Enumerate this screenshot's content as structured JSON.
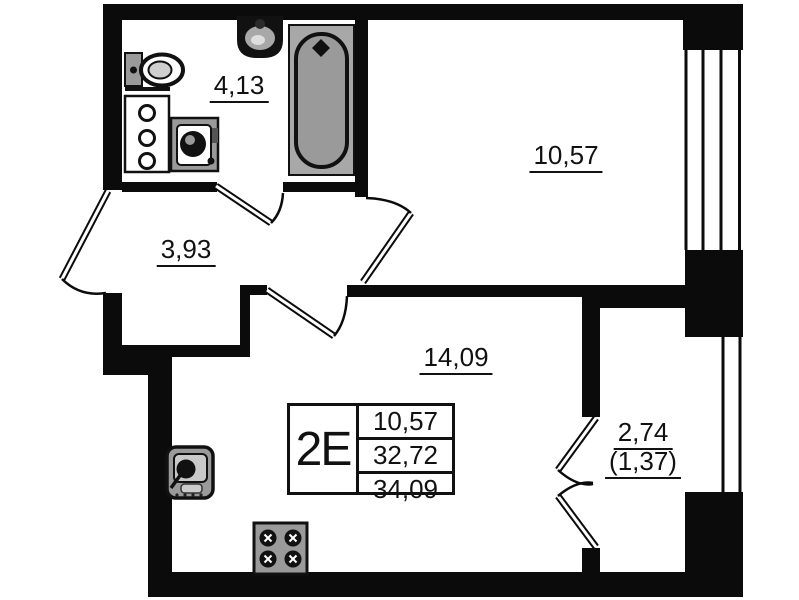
{
  "plan": {
    "stamp": {
      "unit_type": "2Е",
      "rows": [
        "10,57",
        "32,72",
        "34,09"
      ]
    },
    "rooms": {
      "bathroom": {
        "area": "4,13"
      },
      "hallway": {
        "area": "3,93"
      },
      "bedroom": {
        "area": "10,57"
      },
      "kitchen_living": {
        "area": "14,09"
      },
      "balcony": {
        "area": "2,74",
        "area_with_coefficient": "(1,37)"
      }
    }
  }
}
